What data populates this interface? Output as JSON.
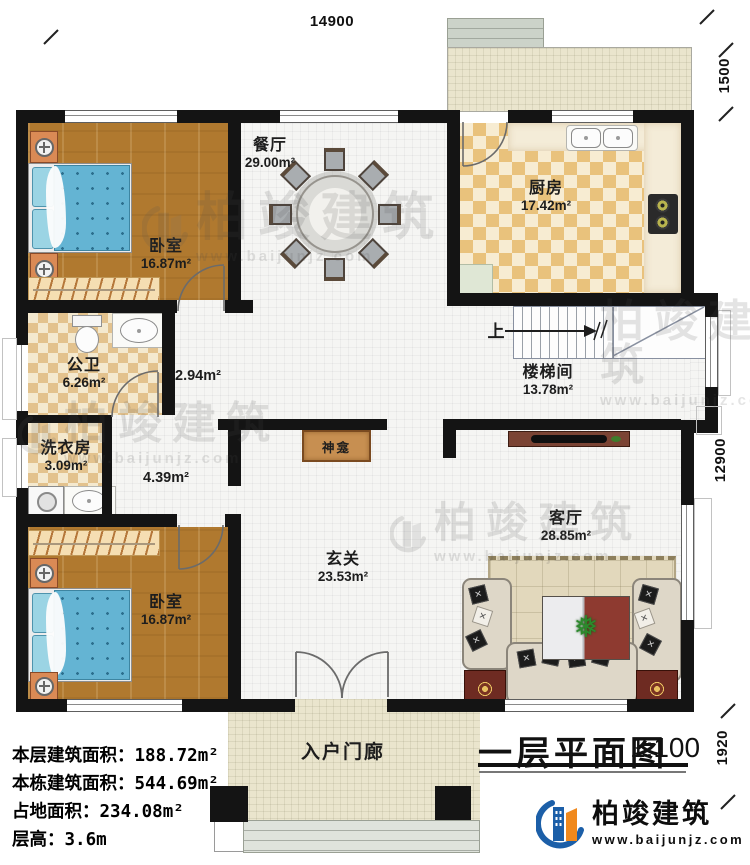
{
  "title_block": {
    "title": "一层平面图",
    "scale": "1:100"
  },
  "dimensions": {
    "top_width": "14900",
    "terrace_depth": "1500",
    "building_depth": "12900",
    "porch_depth": "1920"
  },
  "rooms": {
    "bedroom_tl": {
      "name": "卧室",
      "area": "16.87m²"
    },
    "dining": {
      "name": "餐厅",
      "area": "29.00m²"
    },
    "kitchen": {
      "name": "厨房",
      "area": "17.42m²"
    },
    "stairwell": {
      "name": "楼梯间",
      "area": "13.78m²"
    },
    "bathroom": {
      "name": "公卫",
      "area": "6.26m²"
    },
    "laundry": {
      "name": "洗衣房",
      "area": "3.09m²"
    },
    "hall_upper": {
      "area": "2.94m²"
    },
    "hall_lower": {
      "area": "4.39m²"
    },
    "foyer": {
      "name": "玄关",
      "area": "23.53m²"
    },
    "living": {
      "name": "客厅",
      "area": "28.85m²"
    },
    "bedroom_bl": {
      "name": "卧室",
      "area": "16.87m²"
    },
    "porch": {
      "name": "入户门廊"
    }
  },
  "annotations": {
    "stair_direction": "上",
    "shrine": "神龛"
  },
  "stats": [
    {
      "label": "本层建筑面积：",
      "value": "188.72m²"
    },
    {
      "label": "本栋建筑面积：",
      "value": "544.69m²"
    },
    {
      "label": "占地面积：",
      "value": "234.08m²"
    },
    {
      "label": "层高：",
      "value": "3.6m"
    }
  ],
  "brand": {
    "name": "柏竣建筑",
    "url": "www.baijunjz.com"
  },
  "colors": {
    "wall": "#141414",
    "wood_floor": "#b0792f",
    "kitchen_tile": "#e9c27c",
    "bed": "#64b4d3",
    "terrace": "#eae5cd",
    "accent_blue": "#1c5fa8",
    "accent_orange": "#f0891d"
  }
}
